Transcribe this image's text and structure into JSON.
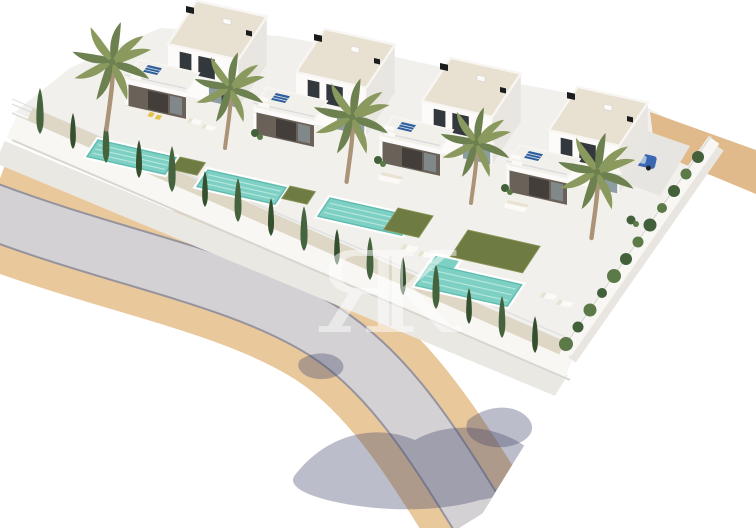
{
  "meta": {
    "kind": "architectural-3d-render",
    "description": "Aerial 3D visualization of a residential development: four modern white two-storey villas in a row, each with flat roof terraces, solar panels, private turquoise pool, artificial lawn, palm trees and cypress hedges behind a white perimeter wall with railing, fronted by a curving asphalt road with tan paved sidewalks on a white background",
    "villa_count": 4,
    "pool_count": 4,
    "palm_count": 5
  },
  "watermark": {
    "text": "ЯK",
    "color": "#ffffff",
    "opacity": "0.5"
  },
  "colors": {
    "background": "#ffffff",
    "platform": "#f1f0ec",
    "wall": "#f8f7f4",
    "wall_edge": "#dfddd7",
    "wall_shadow": "#d8d6d0",
    "railing": "#d9d9de",
    "road": "#d4d1d4",
    "road_edge": "#95939d",
    "sidewalk": "#e9c89c",
    "walk_inner": "#eae8e3",
    "sand": "#e0ba8b",
    "driveway": "#e7e5e1",
    "car_body": "#3a66b2",
    "car_glass": "#a8c0dc",
    "house_front": "#fcfbf9",
    "house_side": "#e9e6e1",
    "roof_deck": "#e8e0d1",
    "roof_edge": "#f8f6f2",
    "porch_roof": "#f2f0eb",
    "porch_dark": "#6a6158",
    "door_dark": "#433e39",
    "glass": "#8c9da4",
    "window_dark": "#32383c",
    "solar": "#2f5f9c",
    "vent": "#1a1c1e",
    "terrace": "#f2f0ea",
    "pool_coping": "#ffffff",
    "pool_water": "#7fd0c4",
    "pool_deep": "#5fbcae",
    "pool_ripple": "#b7e8dd",
    "lawn": "#6e7b42",
    "lawn_light": "#8a9455",
    "gravel": "#ded7c6",
    "cypress": "#45633c",
    "cypress_dark": "#35502e",
    "hedge": "#5c7a48",
    "hedge_dark": "#42603a",
    "palm_leaf": "#8a9a5e",
    "palm_leaf_dark": "#6d8150",
    "palm_trunk": "#ab9377",
    "lounger": "#fbfaf7",
    "lounger_mat": "#e9e2d2",
    "accent_yellow": "#e4c04c",
    "shadow": "#45486c"
  }
}
